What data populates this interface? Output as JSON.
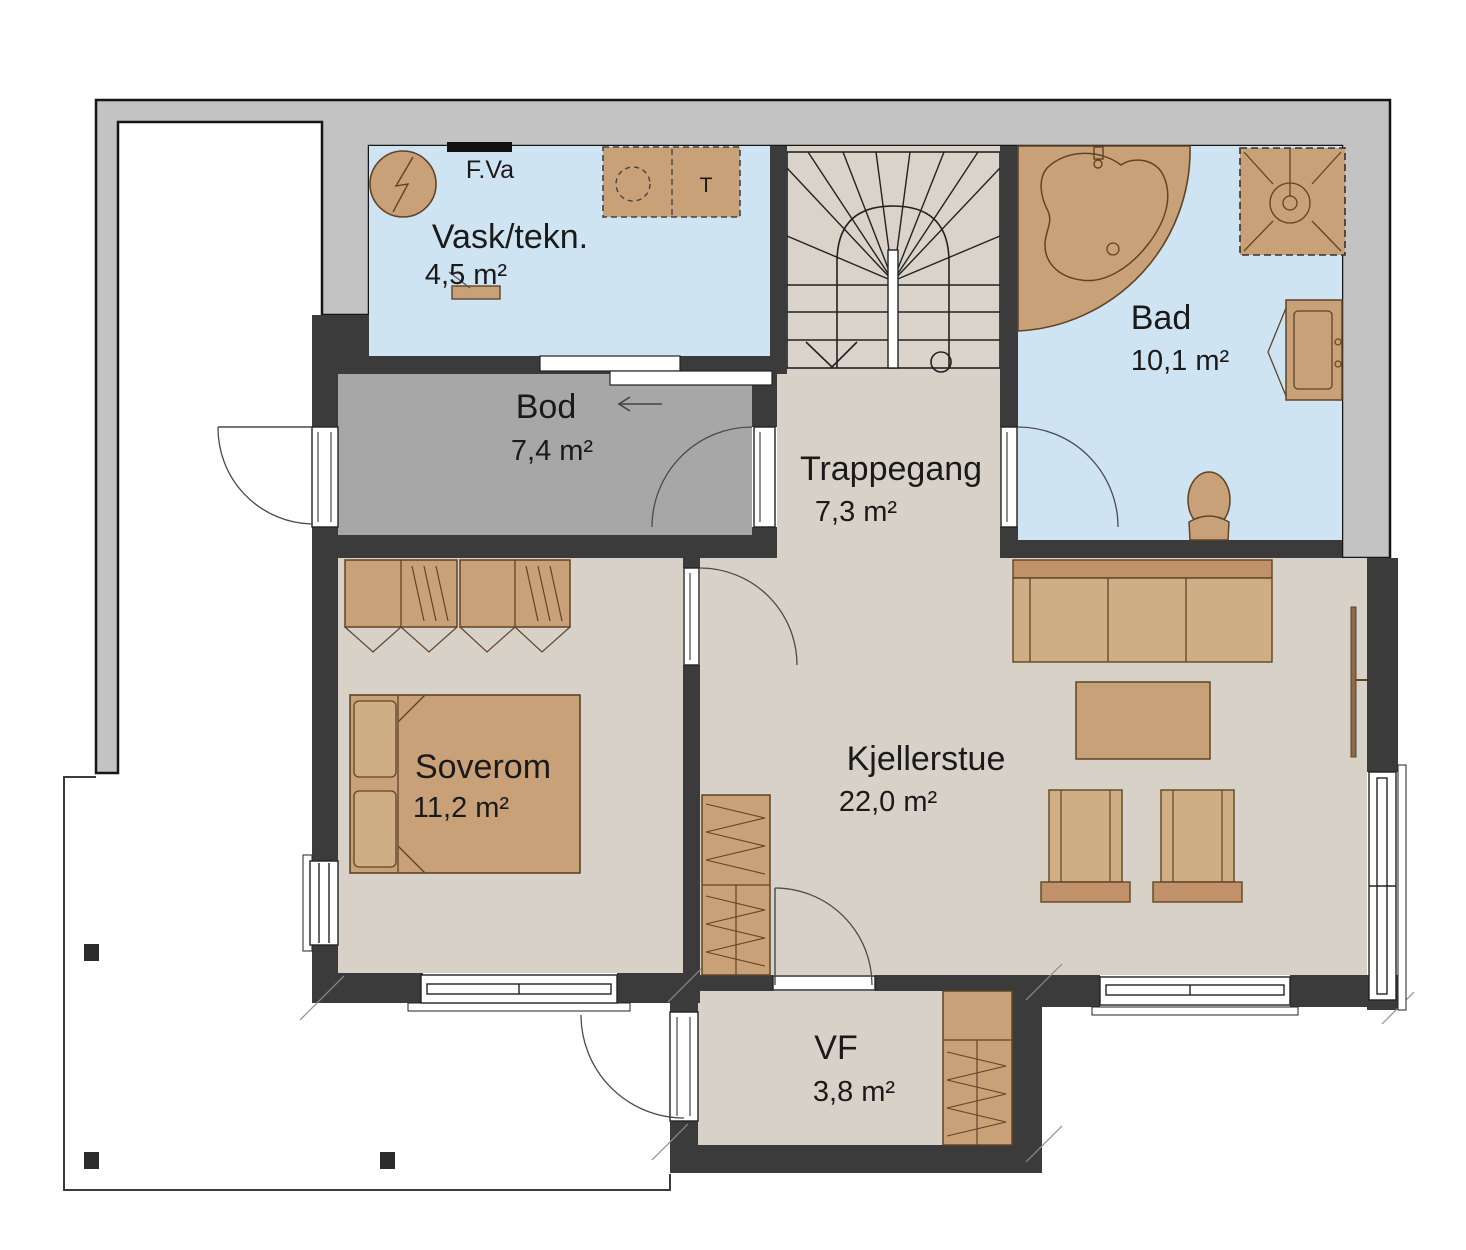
{
  "rooms": [
    {
      "name": "Vask/tekn.",
      "area": "4,5 m²"
    },
    {
      "name": "Bod",
      "area": "7,4 m²"
    },
    {
      "name": "Trappegang",
      "area": "7,3 m²"
    },
    {
      "name": "Bad",
      "area": "10,1 m²"
    },
    {
      "name": "Soverom",
      "area": "11,2 m²"
    },
    {
      "name": "Kjellerstue",
      "area": "22,0 m²"
    },
    {
      "name": "VF",
      "area": "3,8 m²"
    }
  ],
  "annotations": {
    "water_heater_label": "F.Va",
    "dryer_label": "T"
  },
  "colors": {
    "wall": "#3b3b3b",
    "concrete_band": "#c3c3c3",
    "wet_room_floor": "#cfe4f3",
    "storage_floor": "#a7a7a7",
    "living_floor": "#d8d1c7",
    "furniture_brown": "#c9a178",
    "furniture_dark_brown": "#c1916a"
  }
}
